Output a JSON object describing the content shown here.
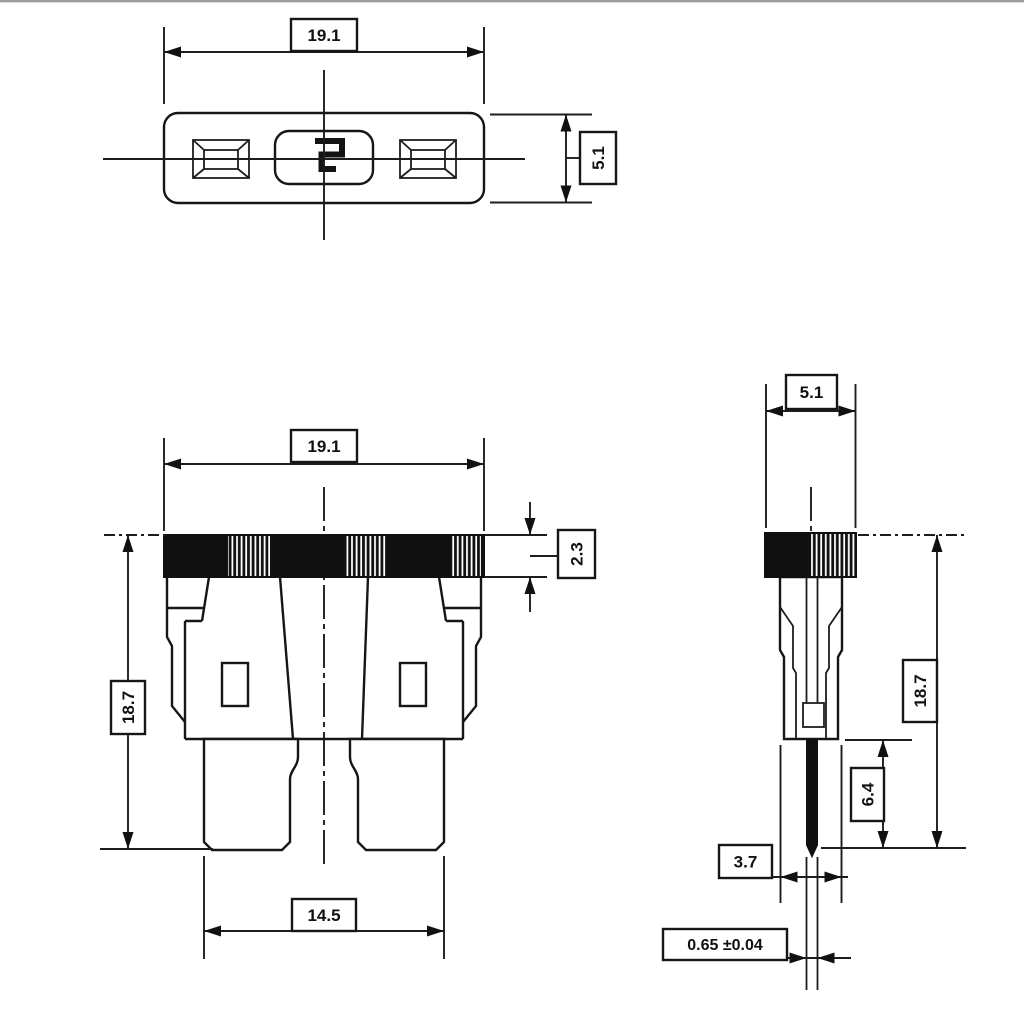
{
  "drawing": {
    "title": "blade-fuse-dimension-drawing",
    "colors": {
      "ink": "#161616",
      "paper": "#ffffff",
      "cap_fill": "#101010",
      "top_border": "#9d9d9d"
    }
  },
  "dims": {
    "top_width": "19.1",
    "top_depth": "5.1",
    "front_width": "19.1",
    "front_height": "18.7",
    "front_cap_height": "2.3",
    "front_terminal_span": "14.5",
    "side_depth": "5.1",
    "side_height": "18.7",
    "side_terminal_length": "6.4",
    "side_body_thickness": "3.7",
    "side_blade_thickness": "0.65 ±0.04"
  }
}
